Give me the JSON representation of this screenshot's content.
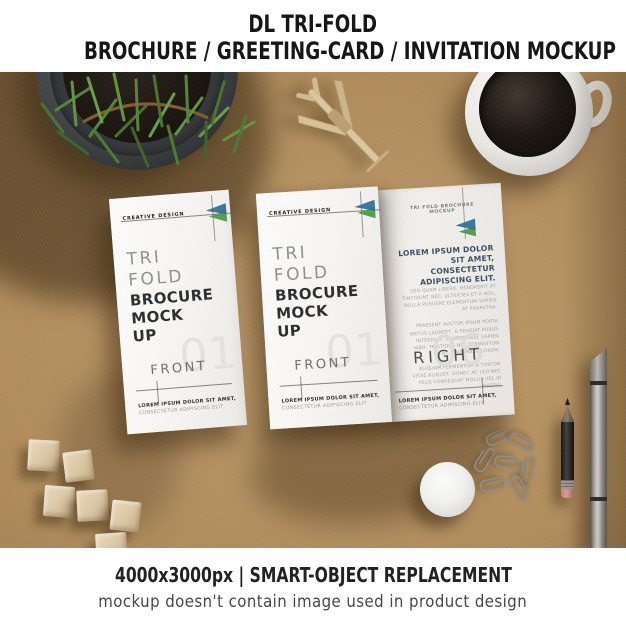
{
  "header": {
    "line1": "DL TRI-FOLD",
    "line2": "BROCHURE / GREETING-CARD / INVITATION MOCKUP"
  },
  "footer": {
    "line1": "4000x3000px | SMART-OBJECT REPLACEMENT",
    "line2": "mockup doesn't contain image used in product design"
  },
  "brochure_front": {
    "brand": "CREATIVE DESIGN",
    "title_light_1": "TRI",
    "title_light_2": "FOLD",
    "title_bold_1": "BROCURE",
    "title_bold_2": "MOCK",
    "title_bold_3": "UP",
    "section_label": "FRONT",
    "section_number": "01",
    "footer_bold": "LOREM IPSUM DOLOR SIT AMET,",
    "footer_light": "CONSECTETUR ADIPISCING ELIT"
  },
  "brochure_inside": {
    "header": "TRI FOLD BROCHURE MOCKUP",
    "heading": "LOREM IPSUM DOLOR SIT AMET, CONSECTETUR ADIPISCING ELIT.",
    "para1": "SED QUAM LIBERO, HENDRERIT AT TINCIDUNT NEC, ULTRICIES ET A NISL. NULLA POSUERE ELEMENTUM SAPIEN AT PHARETRA.",
    "para2": "PRAESENT AUCTOR IPSUM PORTA METUS LAOREET, A FEUGIAT PURUS INTERDUM. SUSPENDISSE SAPIEN NIBH, TRISTIQUE NEC FERMENTUM AT, VIVERRA ID LOREM.",
    "para3": "ALIQUAM FERMENTUM A TORTOR VITAE ALIQUET. DONEC AC LEO NEC FELIS CONSEQUAT MOLLIS VEL ID MAGNA.",
    "section_label": "RIGHT",
    "section_number": "06",
    "footer_bold": "LOREM IPSUM DOLOR SIT AMET,",
    "footer_light": "CONSECTETUR ADIPISCING ELIT"
  },
  "colors": {
    "kraft_background": "#b08c5c",
    "accent_blue": "#2a6c9c",
    "accent_green": "#54a04b",
    "inside_heading": "#3d4e63",
    "header_text": "#161616"
  },
  "scene": {
    "props": [
      "plant-pot",
      "toy-airplane",
      "coffee-mug",
      "wood-cubes",
      "pin-badge",
      "paper-clips",
      "pencil",
      "craft-knife"
    ]
  }
}
